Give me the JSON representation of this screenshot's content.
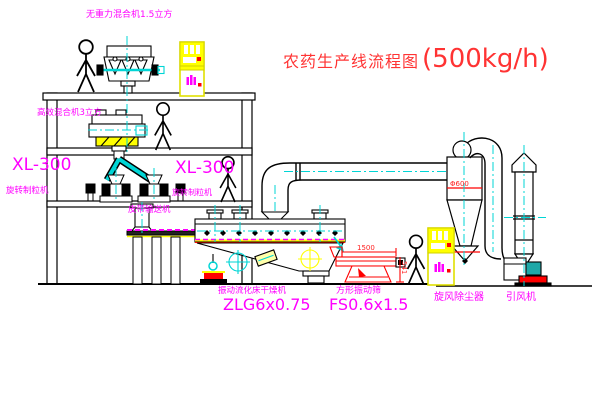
{
  "diagram": {
    "title": {
      "text": "农药生产线流程图",
      "capacity": "(500kg/h)"
    },
    "equipment_labels": {
      "top_mixer": "无重力混合机1.5立方",
      "floor2_mixer": "高效混合机3立方",
      "granulator_left_model": "XL-300",
      "granulator_left_name": "旋转制粒机",
      "granulator_right_model": "XL-300",
      "granulator_right_name": "旋转制粒机",
      "belt_conveyor": "皮带输送机",
      "dryer_name": "振动流化床干燥机",
      "dryer_model": "ZLG6x0.75",
      "screen_name": "方形振动筛",
      "screen_model": "FS0.6x1.5",
      "cyclone": "旋风除尘器",
      "fan": "引风机"
    },
    "dimensions": {
      "screen_length": "1500",
      "screen_height": "541",
      "cyclone_note": "Φ600"
    },
    "colors": {
      "label_magenta": "#ff00ff",
      "title_red": "#ff3333",
      "line_black": "#000000",
      "centerline_cyan": "#00d5d5",
      "cabinet_yellow": "#ffff00",
      "screen_red": "#ff0000"
    }
  }
}
